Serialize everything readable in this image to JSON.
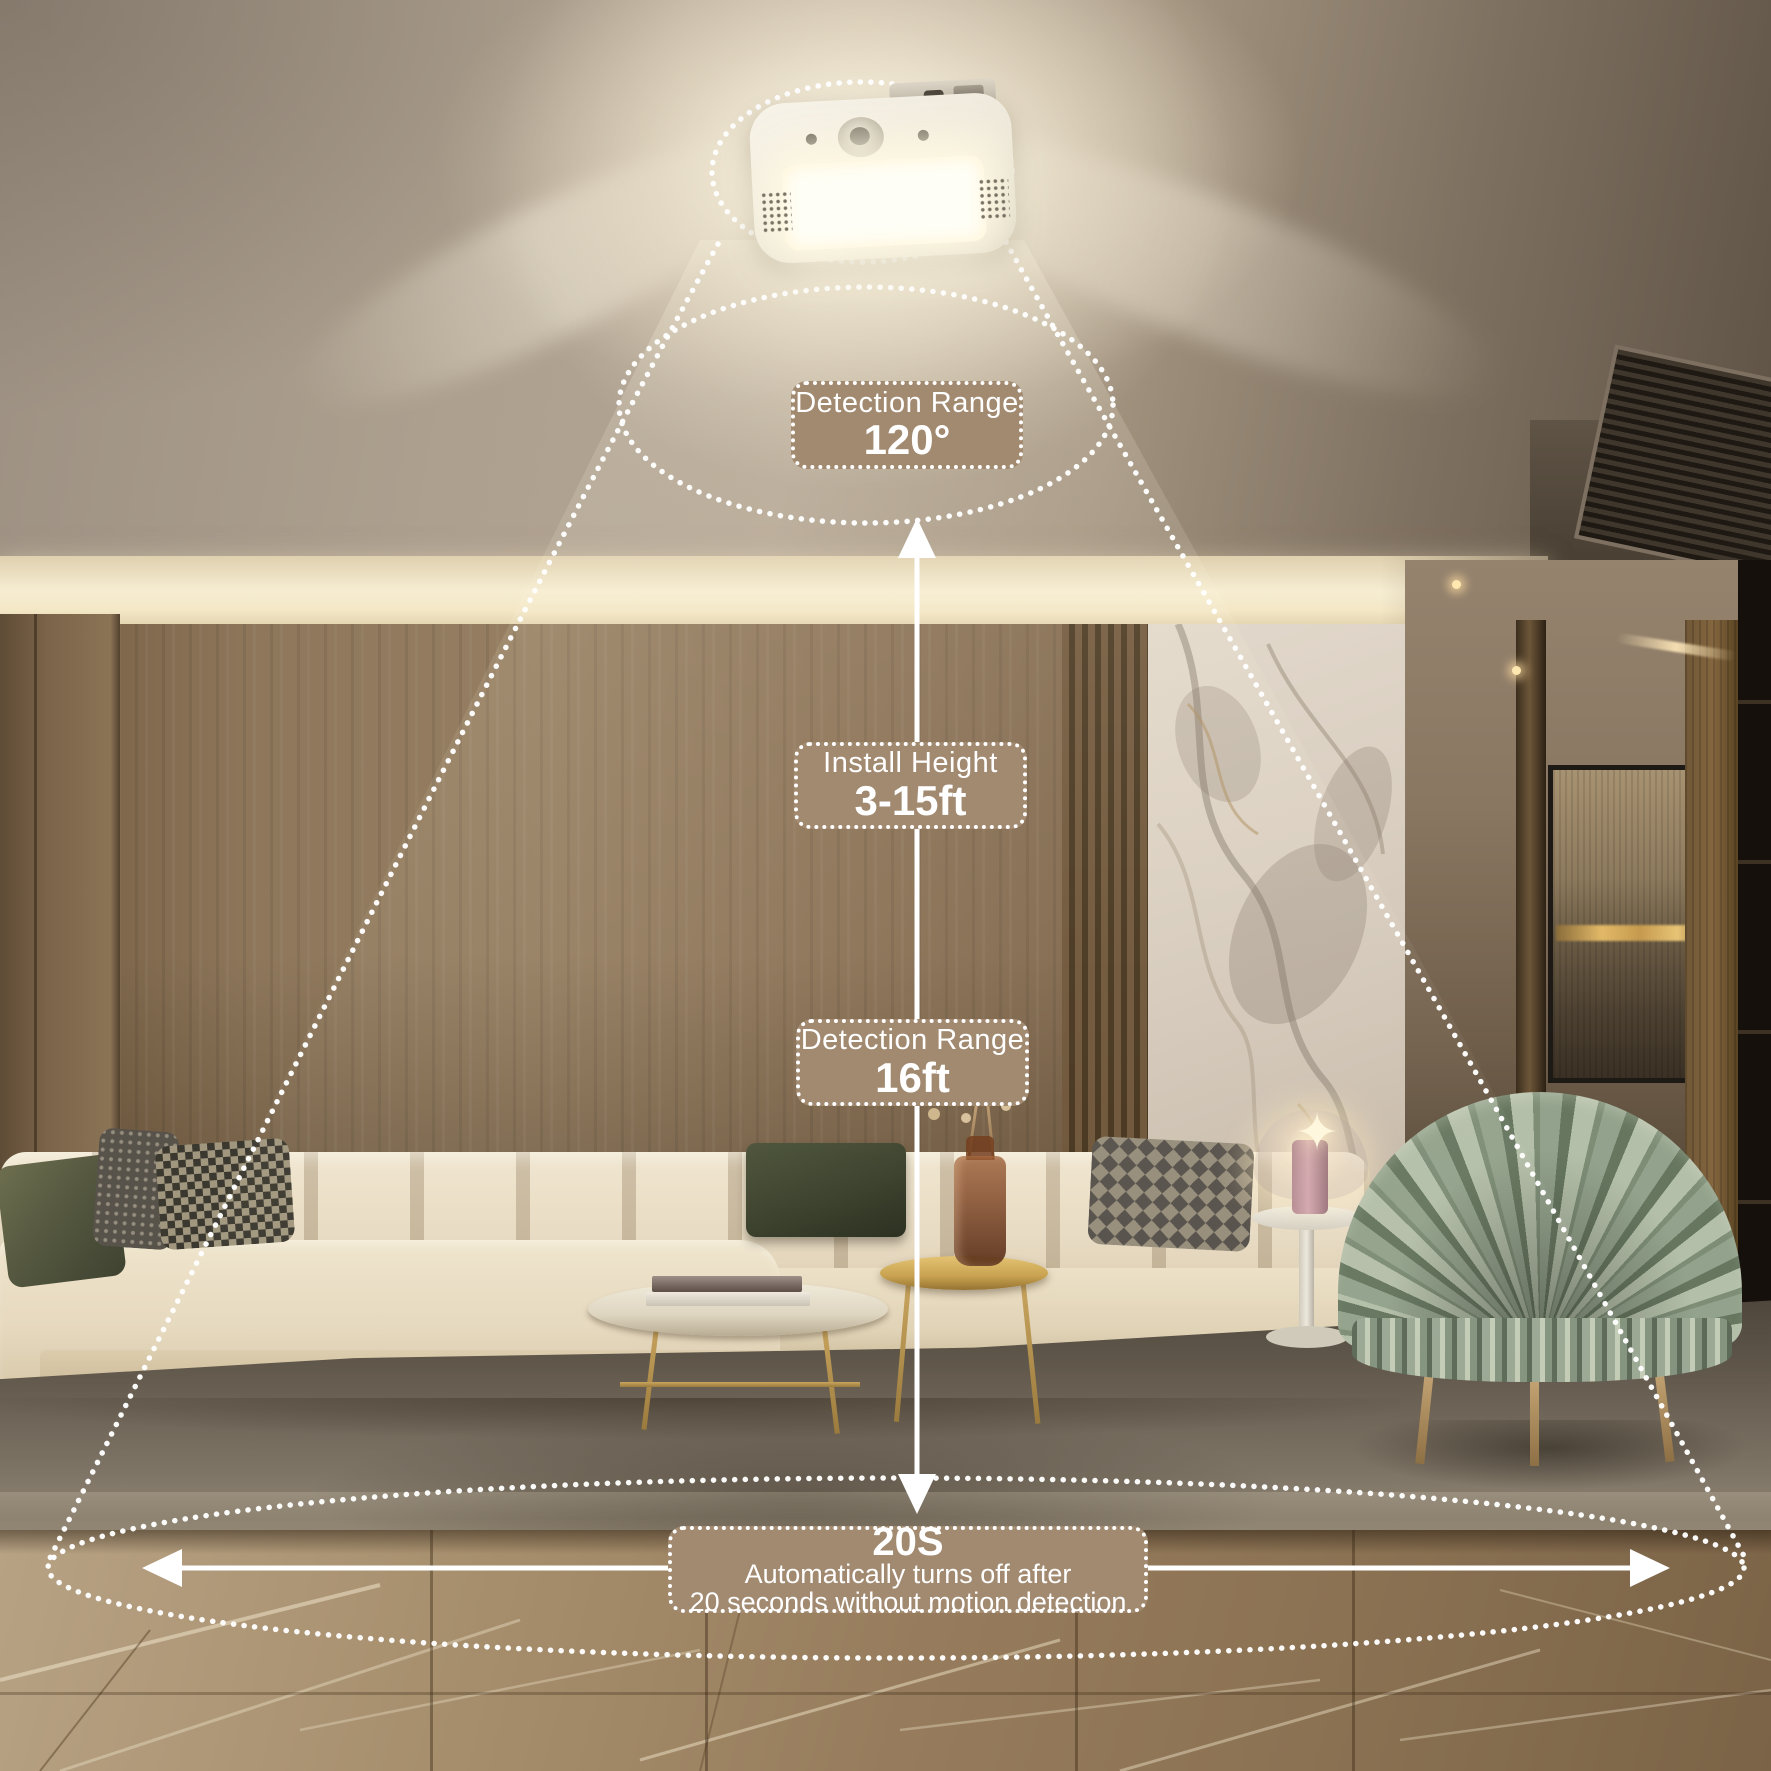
{
  "product_diagram": {
    "detection_angle": {
      "title": "Detection Range",
      "value": "120°"
    },
    "install_height": {
      "title": "Install Height",
      "value": "3-15ft"
    },
    "detection_distance": {
      "title": "Detection Range",
      "value": "16ft"
    },
    "auto_off": {
      "headline": "20S",
      "line1": "Automatically turns off after",
      "line2": "20 seconds without motion detection"
    }
  },
  "style": {
    "callout_bg": "#a28a71",
    "callout_text": "#ffffff",
    "annotation_color": "#ffffff"
  }
}
